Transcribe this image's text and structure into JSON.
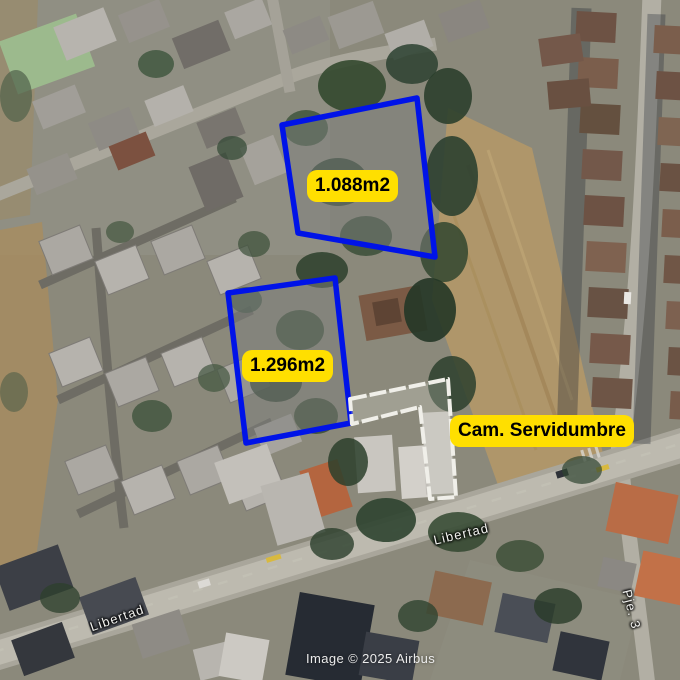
{
  "map": {
    "attribution": "Image © 2025 Airbus",
    "parcels": [
      {
        "id": "parcel-north",
        "area_label": "1.088m2"
      },
      {
        "id": "parcel-south",
        "area_label": "1.296m2"
      }
    ],
    "easement": {
      "label": "Cam. Servidumbre"
    },
    "streets": [
      {
        "name": "Libertad"
      },
      {
        "name": "Libertad"
      },
      {
        "name": "Pje. 3"
      }
    ],
    "colors": {
      "parcel_outline": "#0013e8",
      "annotation_bg": "#ffdf00",
      "annotation_text": "#000000",
      "easement_outline": "#f0efe9",
      "street_label_text": "#f3f3f0",
      "attribution_text": "#ececec"
    }
  }
}
